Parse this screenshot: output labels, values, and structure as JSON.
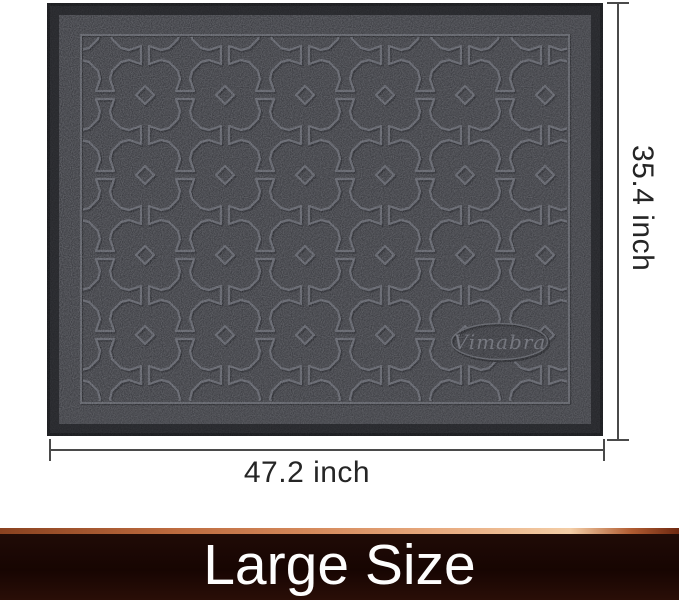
{
  "product_image": {
    "mat": {
      "brand": "Vimabra",
      "surface_color": "#2c2d32",
      "border_color": "#1a1b1e",
      "pattern_line_color": "#51535b",
      "pattern_style": "moroccan-cross-trellis"
    },
    "dimensions": {
      "width_label": "47.2 inch",
      "height_label": "35.4 inch",
      "line_color": "#4a4a4a"
    }
  },
  "banner": {
    "label": "Large Size",
    "text_color": "#fdfdfd",
    "background_color": "#1a0703",
    "accent_line_colors": [
      "#8a4220",
      "#e8ab80",
      "#f3cda6",
      "#6e2810"
    ]
  }
}
